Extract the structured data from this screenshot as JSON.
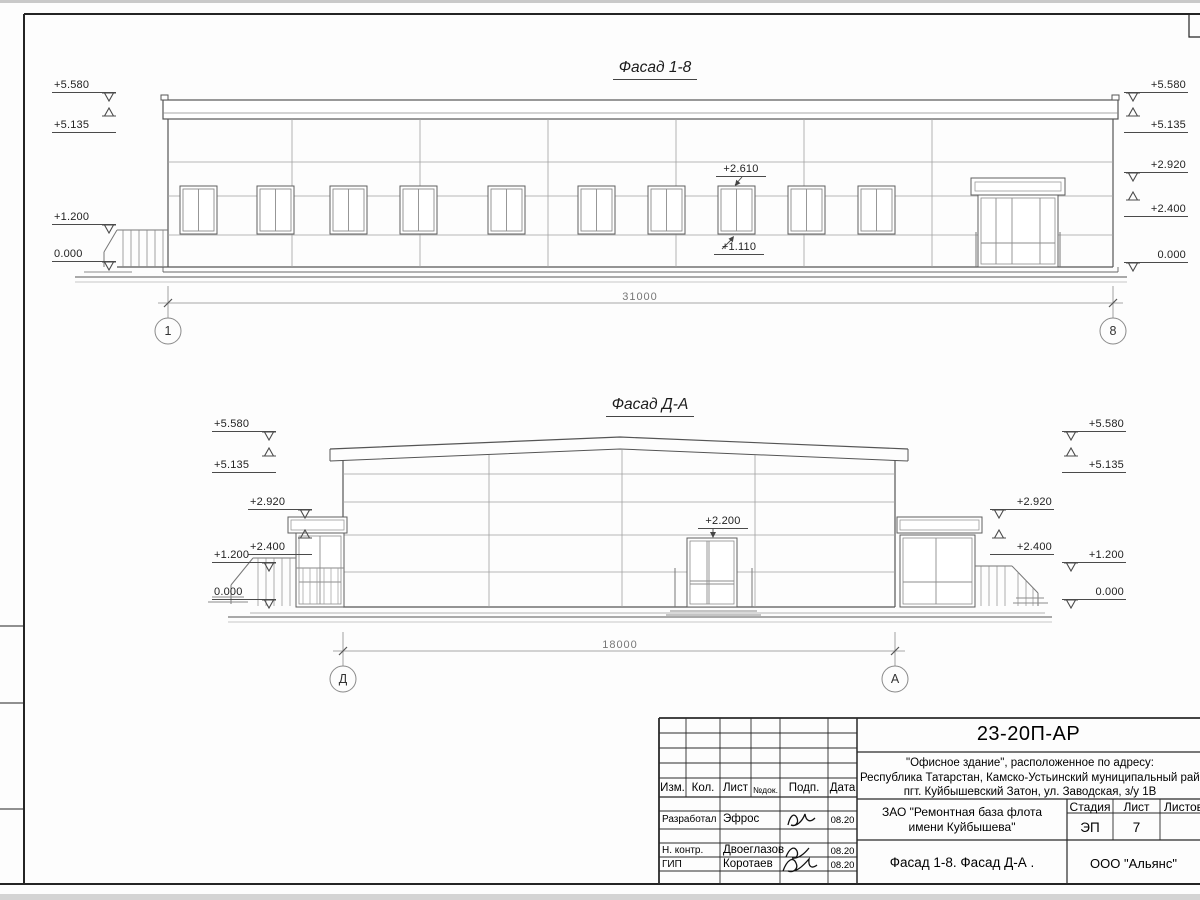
{
  "sheet": {
    "facade1": {
      "title": "Фасад 1-8",
      "dimension": "31000",
      "axis_left": "1",
      "axis_right": "8",
      "marks_left": [
        "+5.580",
        "+5.135",
        "+1.200",
        "0.000"
      ],
      "marks_right": [
        "+5.580",
        "+5.135",
        "+2.920",
        "+2.400",
        "0.000"
      ],
      "mark_window_top": "+2.610",
      "mark_window_bottom": "+1.110"
    },
    "facade2": {
      "title": "Фасад Д-А",
      "dimension": "18000",
      "axis_left": "Д",
      "axis_right": "А",
      "marks_left": [
        "+5.580",
        "+5.135",
        "+2.920",
        "+2.400",
        "+1.200",
        "0.000"
      ],
      "marks_right": [
        "+5.580",
        "+5.135",
        "+2.920",
        "+2.400",
        "+1.200",
        "0.000"
      ],
      "mark_door": "+2.200"
    }
  },
  "titleblock": {
    "doc_number": "23-20П-АР",
    "object_lines": [
      "\"Офисное здание\", расположенное по адресу:",
      "Республика Татарстан, Камско-Устьинский муниципальный район",
      "пгт. Куйбышевский Затон, ул. Заводская, з/у 1В"
    ],
    "client_lines": [
      "ЗАО \"Ремонтная база флота",
      "имени Куйбышева\""
    ],
    "sheet_title": "Фасад 1-8. Фасад Д-А .",
    "company": "ООО \"Альянс\"",
    "columns": [
      "Изм.",
      "Кол.",
      "Лист",
      "№док.",
      "Подп.",
      "Дата"
    ],
    "stage_label": "Стадия",
    "sheet_label": "Лист",
    "sheets_label": "Листов",
    "stage_value": "ЭП",
    "sheet_value": "7",
    "sheets_value": "",
    "signature_rows": [
      {
        "role": "Разработал",
        "name": "Эфрос",
        "date": "08.20"
      },
      {
        "role": "Н. контр.",
        "name": "Двоеглазов",
        "date": "08.20"
      },
      {
        "role": "ГИП",
        "name": "Коротаев",
        "date": "08.20"
      }
    ]
  }
}
